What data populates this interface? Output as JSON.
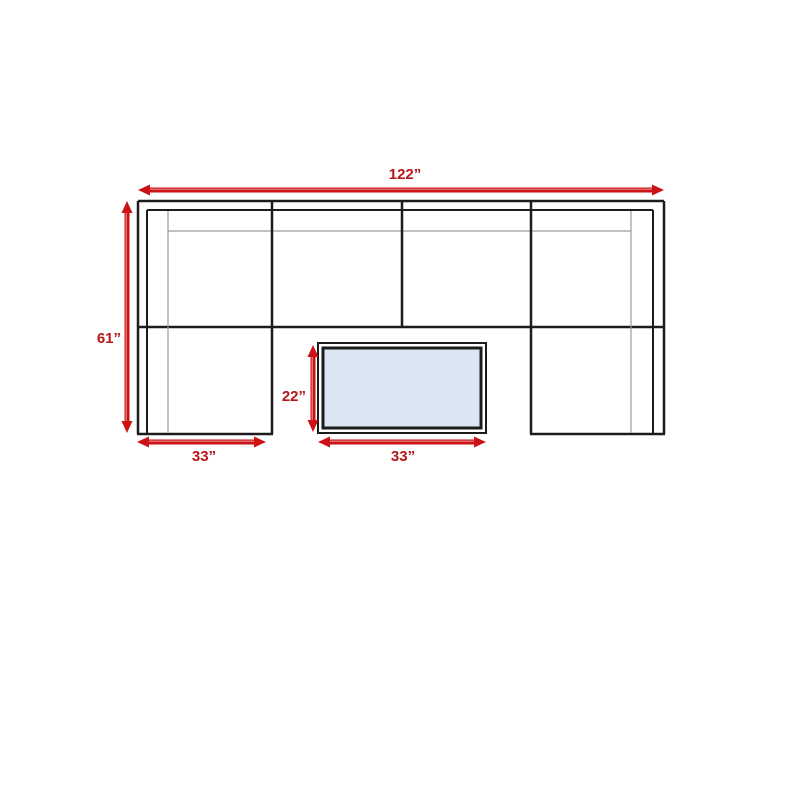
{
  "colors": {
    "line": "#1c1c1c",
    "thin_line": "#9b9b9b",
    "arrow": "#cc1214",
    "arrow_highlight": "rgba(255,255,255,0.5)",
    "label": "#b4171c",
    "table_fill": "#dce6f2",
    "background": "#ffffff"
  },
  "diagram": {
    "canvas": {
      "width": 800,
      "height": 800
    },
    "sofa_lines": [
      {
        "name": "sofa-outer-top",
        "x1": 138,
        "y1": 201,
        "x2": 664,
        "y2": 201,
        "w": 2.5,
        "color": "line"
      },
      {
        "name": "sofa-outer-left",
        "x1": 138,
        "y1": 201,
        "x2": 138,
        "y2": 434,
        "w": 2.5,
        "color": "line"
      },
      {
        "name": "sofa-outer-right",
        "x1": 664,
        "y1": 201,
        "x2": 664,
        "y2": 434,
        "w": 2.5,
        "color": "line"
      },
      {
        "name": "left-arm-bottom",
        "x1": 137,
        "y1": 434,
        "x2": 273,
        "y2": 434,
        "w": 2.5,
        "color": "line"
      },
      {
        "name": "right-arm-bottom",
        "x1": 530,
        "y1": 434,
        "x2": 665,
        "y2": 434,
        "w": 2.5,
        "color": "line"
      },
      {
        "name": "seat-front-line",
        "x1": 138,
        "y1": 327,
        "x2": 664,
        "y2": 327,
        "w": 2.5,
        "color": "line"
      },
      {
        "name": "inner-frame-top",
        "x1": 147,
        "y1": 210,
        "x2": 653,
        "y2": 210,
        "w": 2,
        "color": "line"
      },
      {
        "name": "inner-frame-left",
        "x1": 147,
        "y1": 210,
        "x2": 147,
        "y2": 433,
        "w": 2,
        "color": "line"
      },
      {
        "name": "inner-frame-right",
        "x1": 653,
        "y1": 210,
        "x2": 653,
        "y2": 433,
        "w": 2,
        "color": "line"
      },
      {
        "name": "cushion-line-top",
        "x1": 168,
        "y1": 231,
        "x2": 631,
        "y2": 231,
        "w": 1.2,
        "color": "thin_line"
      },
      {
        "name": "cushion-line-left",
        "x1": 168,
        "y1": 211,
        "x2": 168,
        "y2": 433,
        "w": 1.2,
        "color": "thin_line"
      },
      {
        "name": "cushion-line-right",
        "x1": 631,
        "y1": 211,
        "x2": 631,
        "y2": 433,
        "w": 1.2,
        "color": "thin_line"
      },
      {
        "name": "seat-divider-left",
        "x1": 272,
        "y1": 201,
        "x2": 272,
        "y2": 434,
        "w": 2.5,
        "color": "line"
      },
      {
        "name": "seat-divider-middle",
        "x1": 402,
        "y1": 201,
        "x2": 402,
        "y2": 327,
        "w": 2.5,
        "color": "line"
      },
      {
        "name": "seat-divider-right",
        "x1": 531,
        "y1": 201,
        "x2": 531,
        "y2": 434,
        "w": 2.5,
        "color": "line"
      }
    ],
    "table": {
      "outer": {
        "name": "coffee-table-frame",
        "x": 318,
        "y": 343,
        "w": 168,
        "h": 90,
        "stroke_w": 2,
        "fill": "background",
        "color": "line"
      },
      "top": {
        "name": "coffee-table-top",
        "x": 323,
        "y": 348,
        "w": 158,
        "h": 80,
        "stroke_w": 3,
        "fill": "table_fill",
        "color": "line"
      }
    },
    "dimensions": [
      {
        "id": "sofa-width",
        "label": "122”",
        "orientation": "h",
        "x1": 138,
        "x2": 664,
        "y": 190,
        "label_x": 405,
        "label_y": 179,
        "anchor": "middle"
      },
      {
        "id": "sofa-depth",
        "label": "61”",
        "orientation": "v",
        "y1": 201,
        "y2": 433,
        "x": 127,
        "label_x": 121,
        "label_y": 343,
        "anchor": "end"
      },
      {
        "id": "left-arm-width",
        "label": "33”",
        "orientation": "h",
        "x1": 137,
        "x2": 266,
        "y": 442,
        "label_x": 204,
        "label_y": 461,
        "anchor": "middle"
      },
      {
        "id": "table-depth",
        "label": "22”",
        "orientation": "v",
        "y1": 345,
        "y2": 432,
        "x": 313,
        "label_x": 306,
        "label_y": 401,
        "anchor": "end"
      },
      {
        "id": "table-width",
        "label": "33”",
        "orientation": "h",
        "x1": 318,
        "x2": 486,
        "y": 442,
        "label_x": 403,
        "label_y": 461,
        "anchor": "middle"
      }
    ],
    "arrow_style": {
      "shaft_w": 5,
      "head_len": 12,
      "head_half_w": 5.5
    }
  }
}
